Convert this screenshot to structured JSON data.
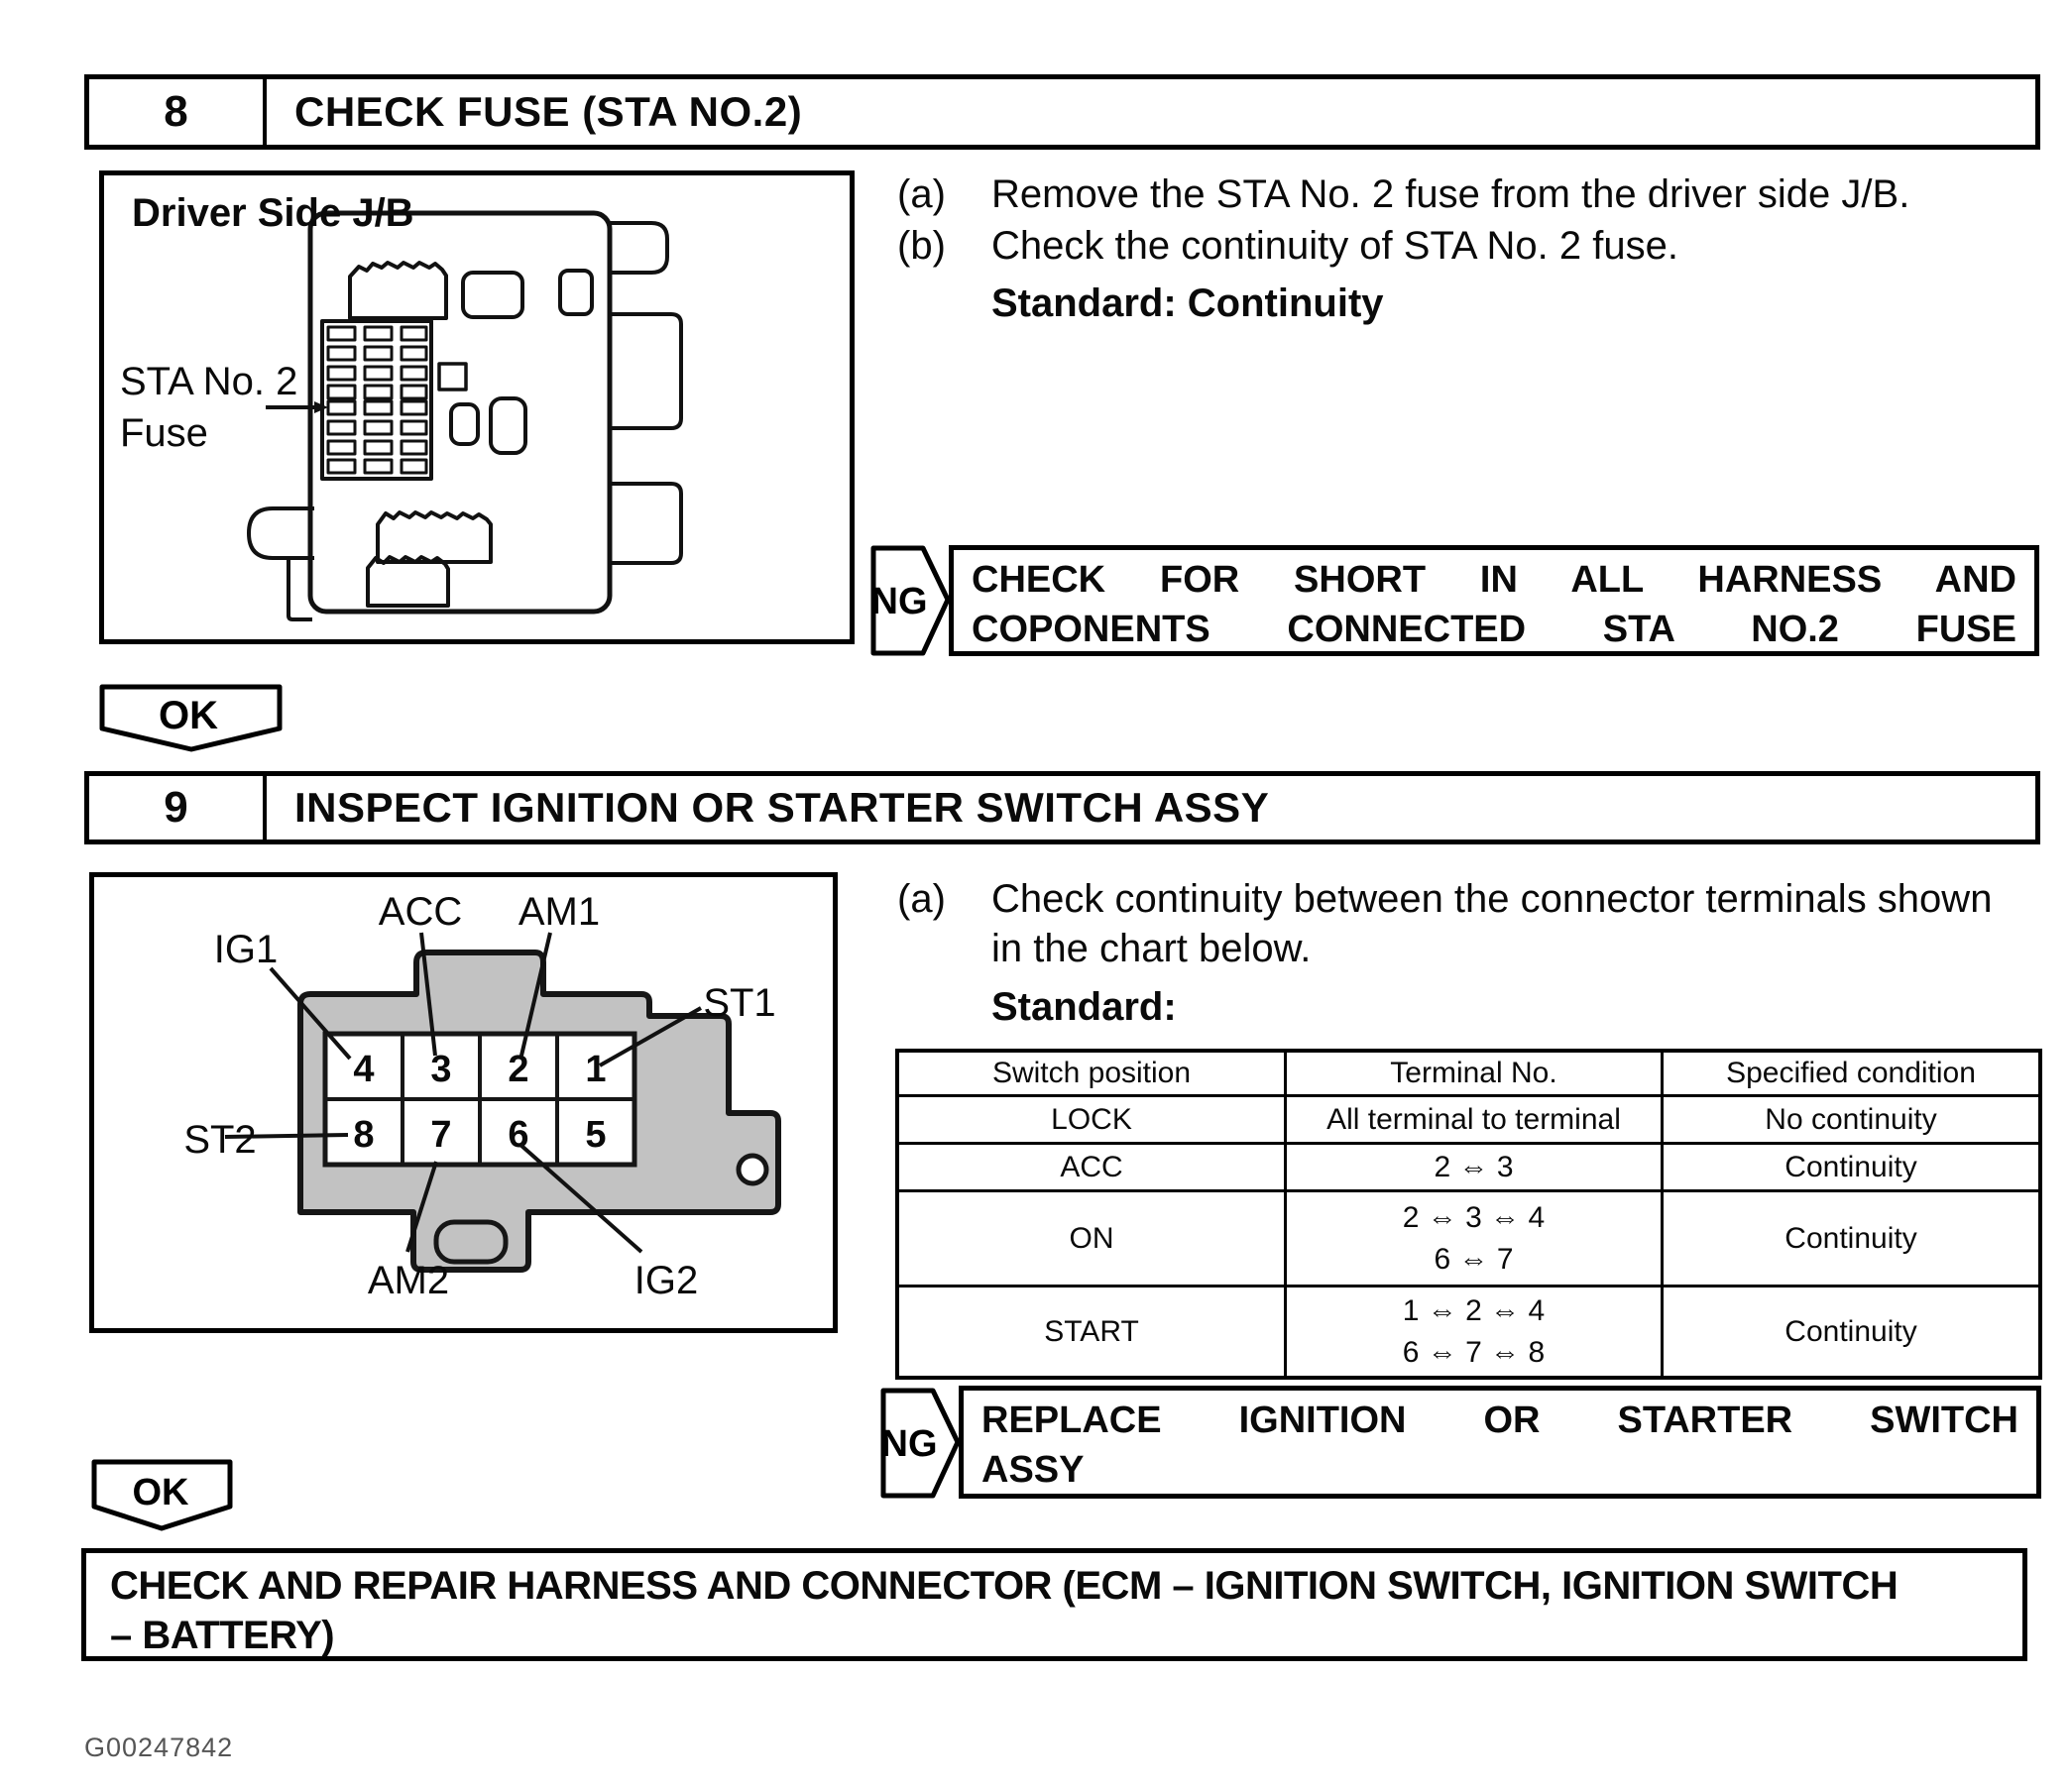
{
  "step8": {
    "number": "8",
    "title": "CHECK FUSE (STA NO.2)",
    "figure": {
      "label": "Driver Side J/B",
      "fuse_label_line1": "STA No. 2",
      "fuse_label_line2": "Fuse"
    },
    "instructions": [
      {
        "marker": "(a)",
        "text": "Remove the STA No. 2 fuse from the driver side J/B."
      },
      {
        "marker": "(b)",
        "text": "Check the continuity of STA No. 2 fuse."
      }
    ],
    "standard": "Standard: Continuity",
    "ng": {
      "label": "NG",
      "line1": "CHECK FOR SHORT IN ALL HARNESS AND",
      "line2": "COPONENTS CONNECTED STA NO.2 FUSE"
    },
    "ok": "OK"
  },
  "step9": {
    "number": "9",
    "title": "INSPECT IGNITION OR STARTER SWITCH ASSY",
    "figure": {
      "labels": {
        "ig1": "IG1",
        "acc": "ACC",
        "am1": "AM1",
        "st1": "ST1",
        "st2": "ST2",
        "am2": "AM2",
        "ig2": "IG2"
      },
      "pins_top": [
        "4",
        "3",
        "2",
        "1"
      ],
      "pins_bottom": [
        "8",
        "7",
        "6",
        "5"
      ]
    },
    "instruction": {
      "marker": "(a)",
      "line1": "Check continuity between the connector terminals shown",
      "line2": "in the chart below."
    },
    "standard": "Standard:",
    "table": {
      "headers": [
        "Switch position",
        "Terminal No.",
        "Specified condition"
      ],
      "rows": [
        {
          "position": "LOCK",
          "terminals": [
            "All terminal to terminal"
          ],
          "condition": "No continuity"
        },
        {
          "position": "ACC",
          "terminals": [
            "2 ⇔ 3"
          ],
          "condition": "Continuity"
        },
        {
          "position": "ON",
          "terminals": [
            "2 ⇔ 3 ⇔ 4",
            "6 ⇔ 7"
          ],
          "condition": "Continuity"
        },
        {
          "position": "START",
          "terminals": [
            "1 ⇔ 2 ⇔ 4",
            "6 ⇔ 7 ⇔ 8"
          ],
          "condition": "Continuity"
        }
      ]
    },
    "ng": {
      "label": "NG",
      "line1": "REPLACE IGNITION OR STARTER SWITCH",
      "line2": "ASSY"
    },
    "ok": "OK"
  },
  "footer": {
    "box_line1": "CHECK AND REPAIR HARNESS AND CONNECTOR (ECM – IGNITION SWITCH, IGNITION SWITCH",
    "box_line2": "– BATTERY)",
    "figure_id": "G00247842"
  }
}
